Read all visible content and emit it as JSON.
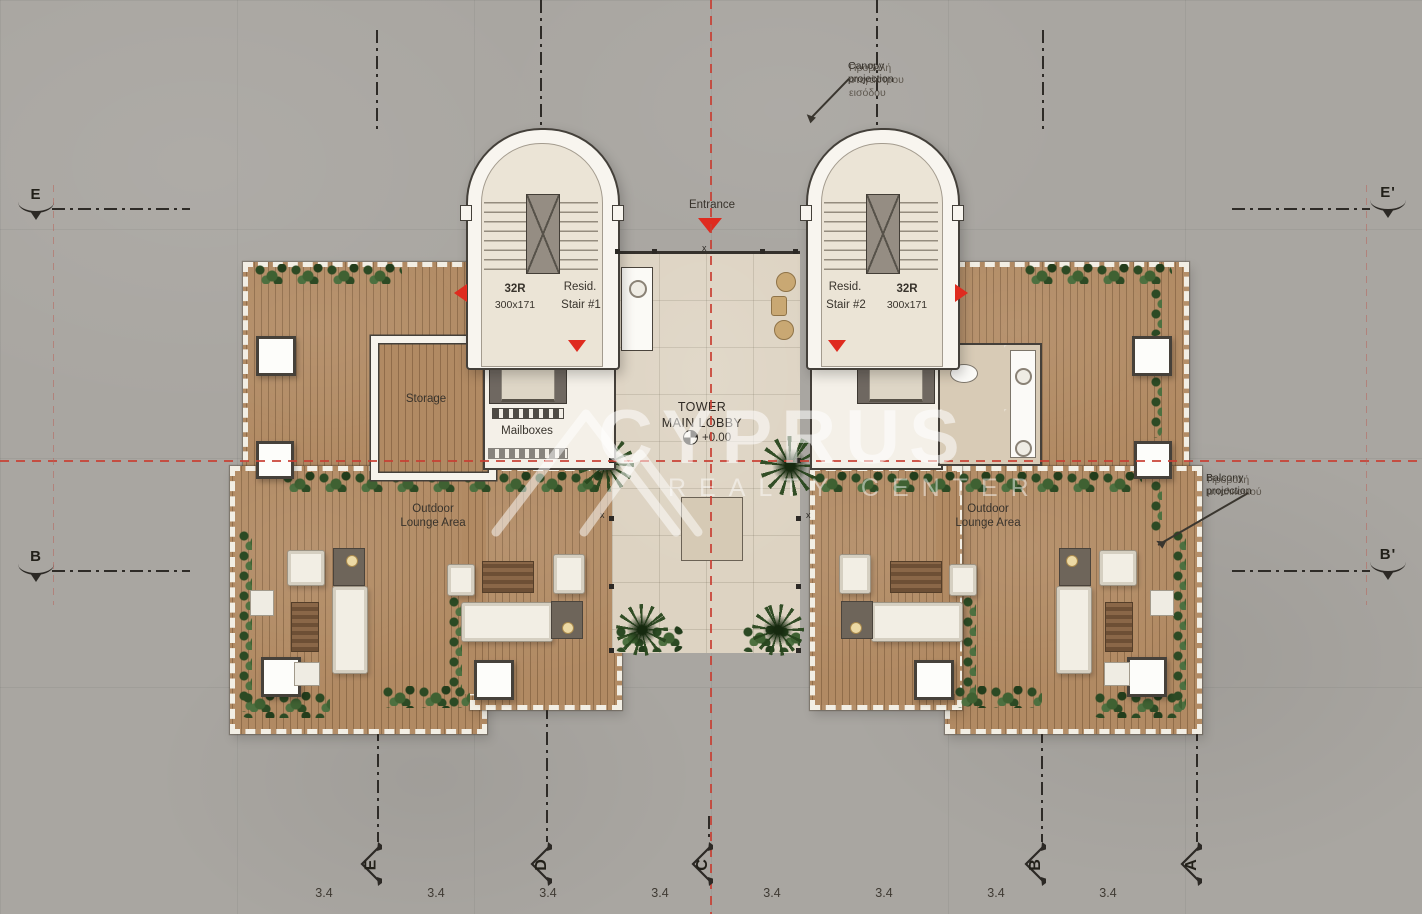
{
  "plan": {
    "entrance": "Entrance",
    "x_mark": "x",
    "lobby": {
      "title1": "TOWER",
      "title2": "MAIN LOBBY",
      "level": "+0.00"
    },
    "rooms": {
      "storage": "Storage",
      "mailboxes": "Mailboxes"
    },
    "lounge": {
      "line1": "Outdoor",
      "line2": "Lounge Area"
    },
    "stair_left": {
      "risers": "32R",
      "size": "300x171",
      "name1": "Resid.",
      "name2": "Stair #1"
    },
    "stair_right": {
      "risers": "32R",
      "size": "300x171",
      "name1": "Resid.",
      "name2": "Stair #2"
    }
  },
  "annotations": {
    "canopy": {
      "en1": "Canopy",
      "en2": "projection",
      "gr1": "Προβολή",
      "gr2": "στεγάστρου",
      "gr3": "εισόδου"
    },
    "balcony": {
      "en1": "Balcony",
      "en2": "projection",
      "gr1": "Προβολή",
      "gr2": "μπαλκονιού"
    }
  },
  "grid": {
    "left": [
      "E",
      "B"
    ],
    "right": [
      "E'",
      "B'"
    ],
    "bottom": [
      "E",
      "D",
      "C",
      "B",
      "A"
    ],
    "dims": [
      "3.4",
      "3.4",
      "3.4",
      "3.4",
      "3.4",
      "3.4",
      "3.4",
      "3.4"
    ]
  },
  "watermark": {
    "brand": "CYPRUS",
    "tagline": "REALTY CENTER"
  },
  "colors": {
    "red": "#df2b1f",
    "deck_wood": "#b18a63",
    "lobby_floor": "#ddd3c2",
    "concrete": "#a9a6a1"
  }
}
